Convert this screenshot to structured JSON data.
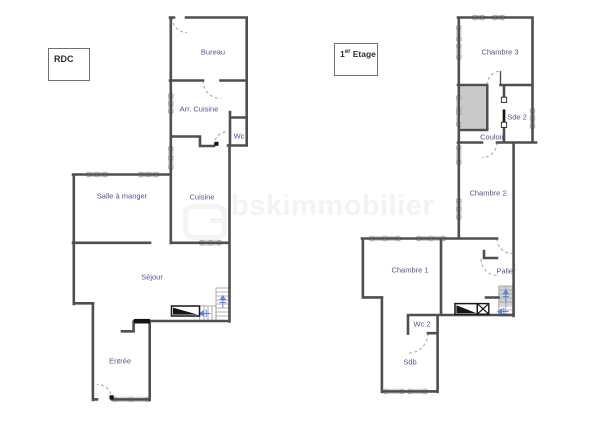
{
  "rdc": {
    "title": "RDC",
    "rooms": {
      "bureau": "Bureau",
      "arr_cuisine": "Arr. Cuisine",
      "wc": "Wc",
      "salle_a_manger": "Salle à manger",
      "cuisine": "Cuisine",
      "sejour": "Séjour",
      "entree": "Entrée"
    }
  },
  "etage1": {
    "title_num": "1",
    "title_sup": "er",
    "title_rest": " Etage",
    "rooms": {
      "chambre3": "Chambre 3",
      "sde2": "Sde 2",
      "couloir": "Couloir",
      "chambre2": "Chambre 2",
      "chambre1": "Chambre 1",
      "palier": "Palier",
      "wc2": "Wc 2",
      "sdb": "Sdb"
    }
  },
  "watermark": {
    "text": "bskimmobilier"
  },
  "colors": {
    "wall": "#4f4f4f",
    "room_label": "#50558e",
    "stair_arrow": "#5f86d8",
    "watermark": "#f3f3f5"
  }
}
